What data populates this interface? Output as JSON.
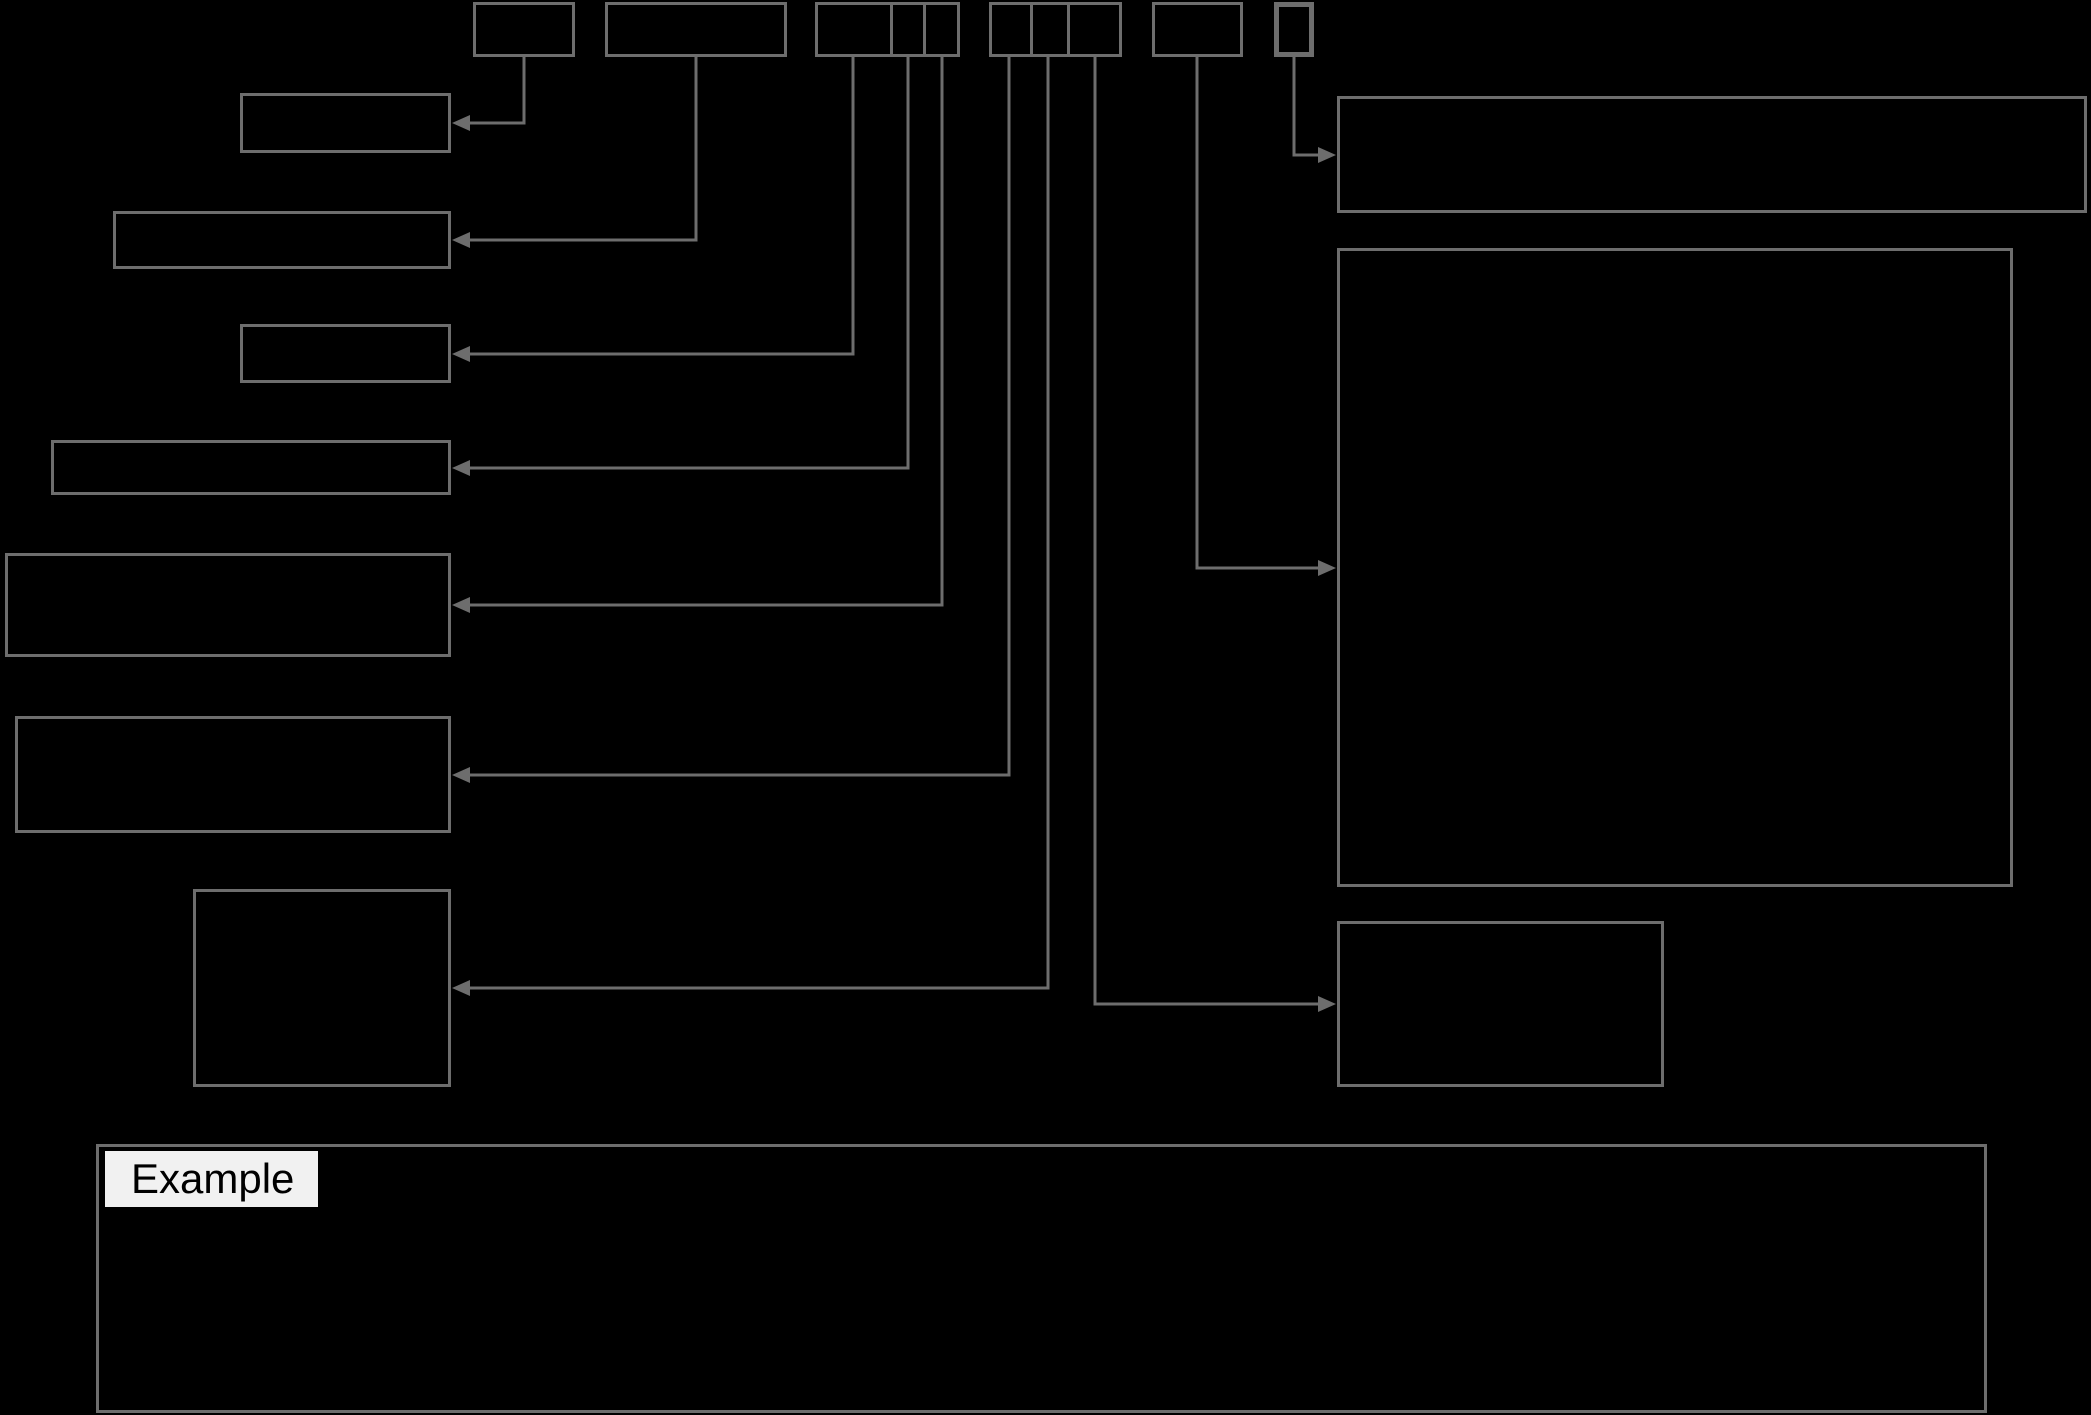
{
  "example_box": {
    "label": "Example"
  },
  "colors": {
    "background": "#000000",
    "box_border": "#6d6d6d",
    "connector_line": "#6d6d6d",
    "arrowhead": "#6d6d6d",
    "example_chip_background": "#f1f1f1",
    "example_chip_text": "#000000"
  }
}
